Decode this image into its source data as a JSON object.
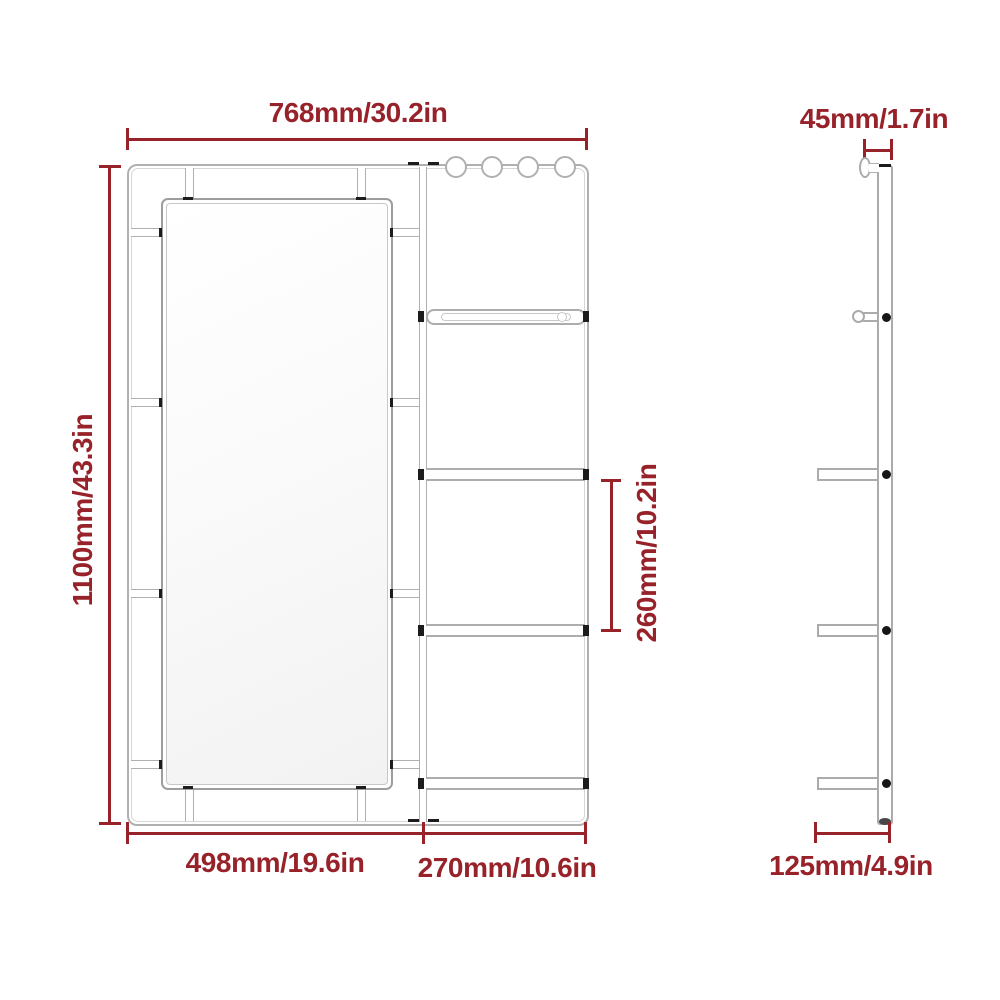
{
  "colors": {
    "dimension_red": "#97222a",
    "drawing_gray": "#b0b0b0",
    "mark_black": "#1c1c1c"
  },
  "front_view": {
    "dimensions": {
      "total_width": "768mm/30.2in",
      "total_height": "1100mm/43.3in",
      "shelf_spacing": "260mm/10.2in",
      "mirror_section_width": "498mm/19.6in",
      "shelf_section_width": "270mm/10.6in"
    }
  },
  "side_view": {
    "dimensions": {
      "frame_depth": "45mm/1.7in",
      "shelf_depth": "125mm/4.9in"
    }
  }
}
